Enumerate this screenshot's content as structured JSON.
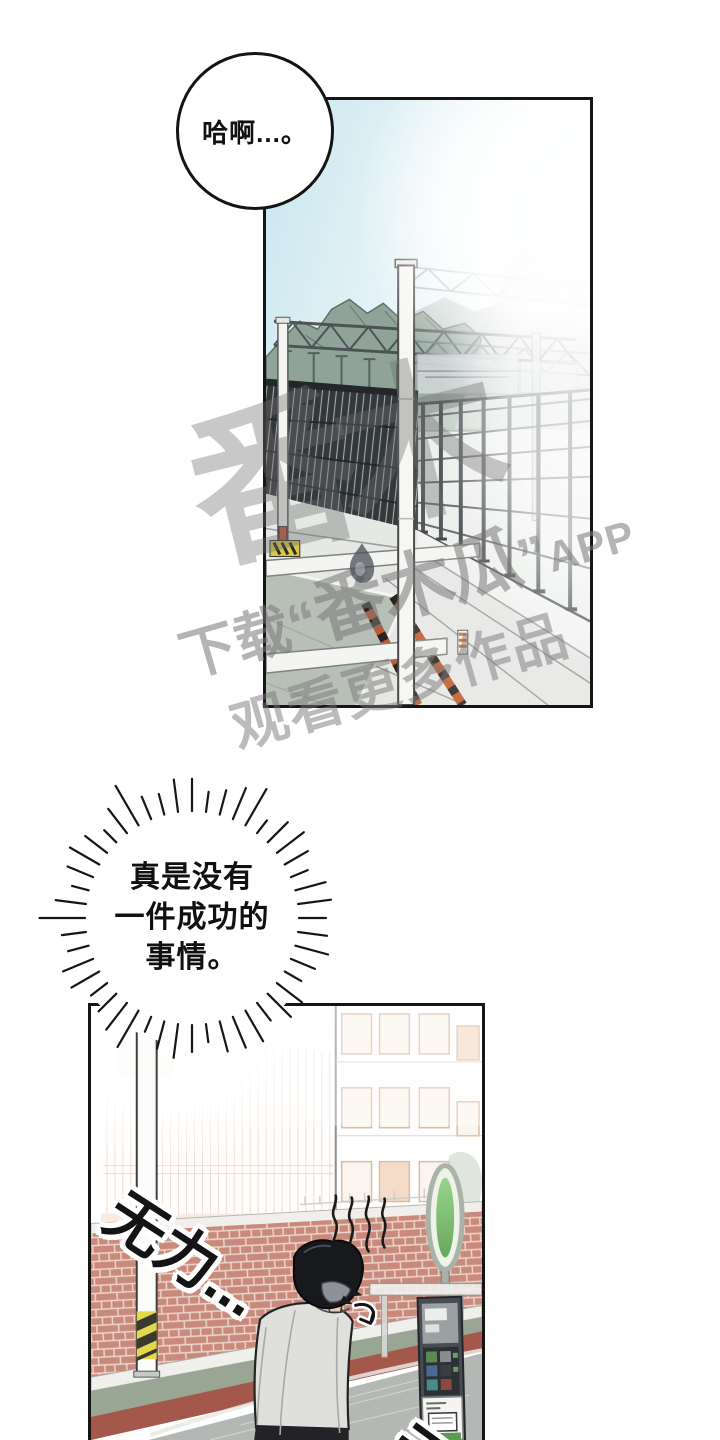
{
  "speech_bubble": {
    "text": "哈啊...。"
  },
  "thought_bubble": {
    "lines": [
      "真是没有",
      "一件成功的",
      "事情。"
    ]
  },
  "sfx": {
    "weak": "无力...",
    "partial_bottom": "无"
  },
  "watermark": {
    "big_glyphs": "番木",
    "prefix": "下载",
    "open_quote": "“",
    "title": "番木瓜",
    "close_quote": "”",
    "suffix": "APP",
    "line2": "观看更多作品"
  },
  "palette": {
    "sky_blue": "#c9e6ef",
    "mountain_green": "#8fa398",
    "brick": "#c9897b",
    "road_red": "#a4584c",
    "sidewalk_green": "#9aa694",
    "signal_green": "#67b05c",
    "hazard_yellow": "#e3d74e",
    "jacket_gray": "#dfdfdd",
    "watermark_gray": "#767676"
  }
}
